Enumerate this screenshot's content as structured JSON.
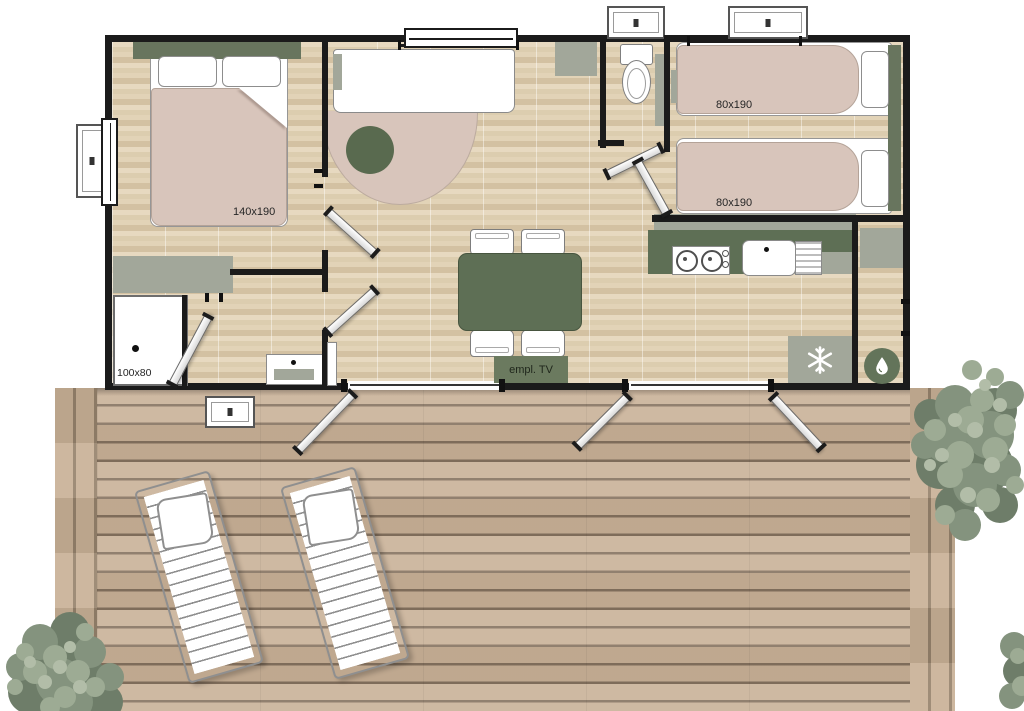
{
  "title": "Mobile home floor plan with terrace",
  "colors": {
    "wall": "#1b1b1b",
    "olive": "#5e6f55",
    "pink": "#d8c5bb",
    "gray_furniture": "#a2a79a",
    "deck_plank": "#c9b197",
    "deck_gap": "#85725f",
    "tree_green": "#84937e"
  },
  "rooms": {
    "master_bedroom": {
      "bed_label": "140x190"
    },
    "bathroom": {
      "shower_label": "100x80"
    },
    "twin_bedroom": {
      "bed_top_label": "80x190",
      "bed_bottom_label": "80x190"
    },
    "living_room": {
      "tv_label": "empl. TV"
    }
  },
  "icons": {
    "fridge": "snowflake-icon",
    "water_heater": "droplet-icon",
    "trees": "tree-top-view",
    "loungers": "sun-lounger"
  }
}
